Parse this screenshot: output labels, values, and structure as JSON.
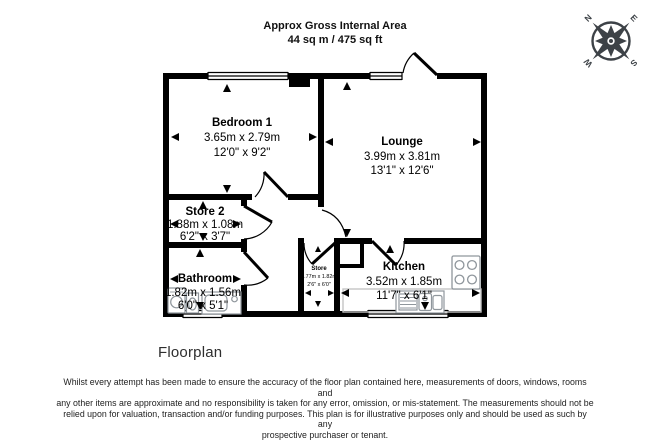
{
  "header": {
    "title_line1": "Approx Gross Internal Area",
    "title_line2": "44 sq m / 475 sq ft"
  },
  "compass": {
    "n": "N",
    "e": "E",
    "s": "S",
    "w": "W"
  },
  "rooms": [
    {
      "name": "Bedroom 1",
      "metric": "3.65m x 2.79m",
      "imperial": "12'0\" x 9'2\""
    },
    {
      "name": "Lounge",
      "metric": "3.99m x 3.81m",
      "imperial": "13'1\" x 12'6\""
    },
    {
      "name": "Store 2",
      "metric": "1.88m x 1.08m",
      "imperial": "6'2\" x 3'7\""
    },
    {
      "name": "Bathroom",
      "metric": "1.82m x 1.56m",
      "imperial": "6'0\" x 5'1\""
    },
    {
      "name": "Store",
      "metric": "0.77m x 1.82m",
      "imperial": "2'6\" x 6'0\""
    },
    {
      "name": "Kitchen",
      "metric": "3.52m x 1.85m",
      "imperial": "11'7\" x 6'1\""
    }
  ],
  "caption": "Floorplan",
  "footer": {
    "disclaimer_lines": [
      "Whilst every attempt has been made to ensure the accuracy of the floor plan contained here, measurements of doors, windows, rooms and",
      "any other items are approximate and no responsibility is taken for any error, omission, or mis-statement. The measurements should not be",
      "relied upon for valuation, transaction and/or funding purposes. This plan is for illustrative purposes only and should be used as such by any",
      "prospective purchaser or tenant."
    ]
  },
  "colors": {
    "wall": "#000000",
    "compass": "#3d4247",
    "fixture": "#8f969c",
    "counter": "#c4c4c4"
  }
}
